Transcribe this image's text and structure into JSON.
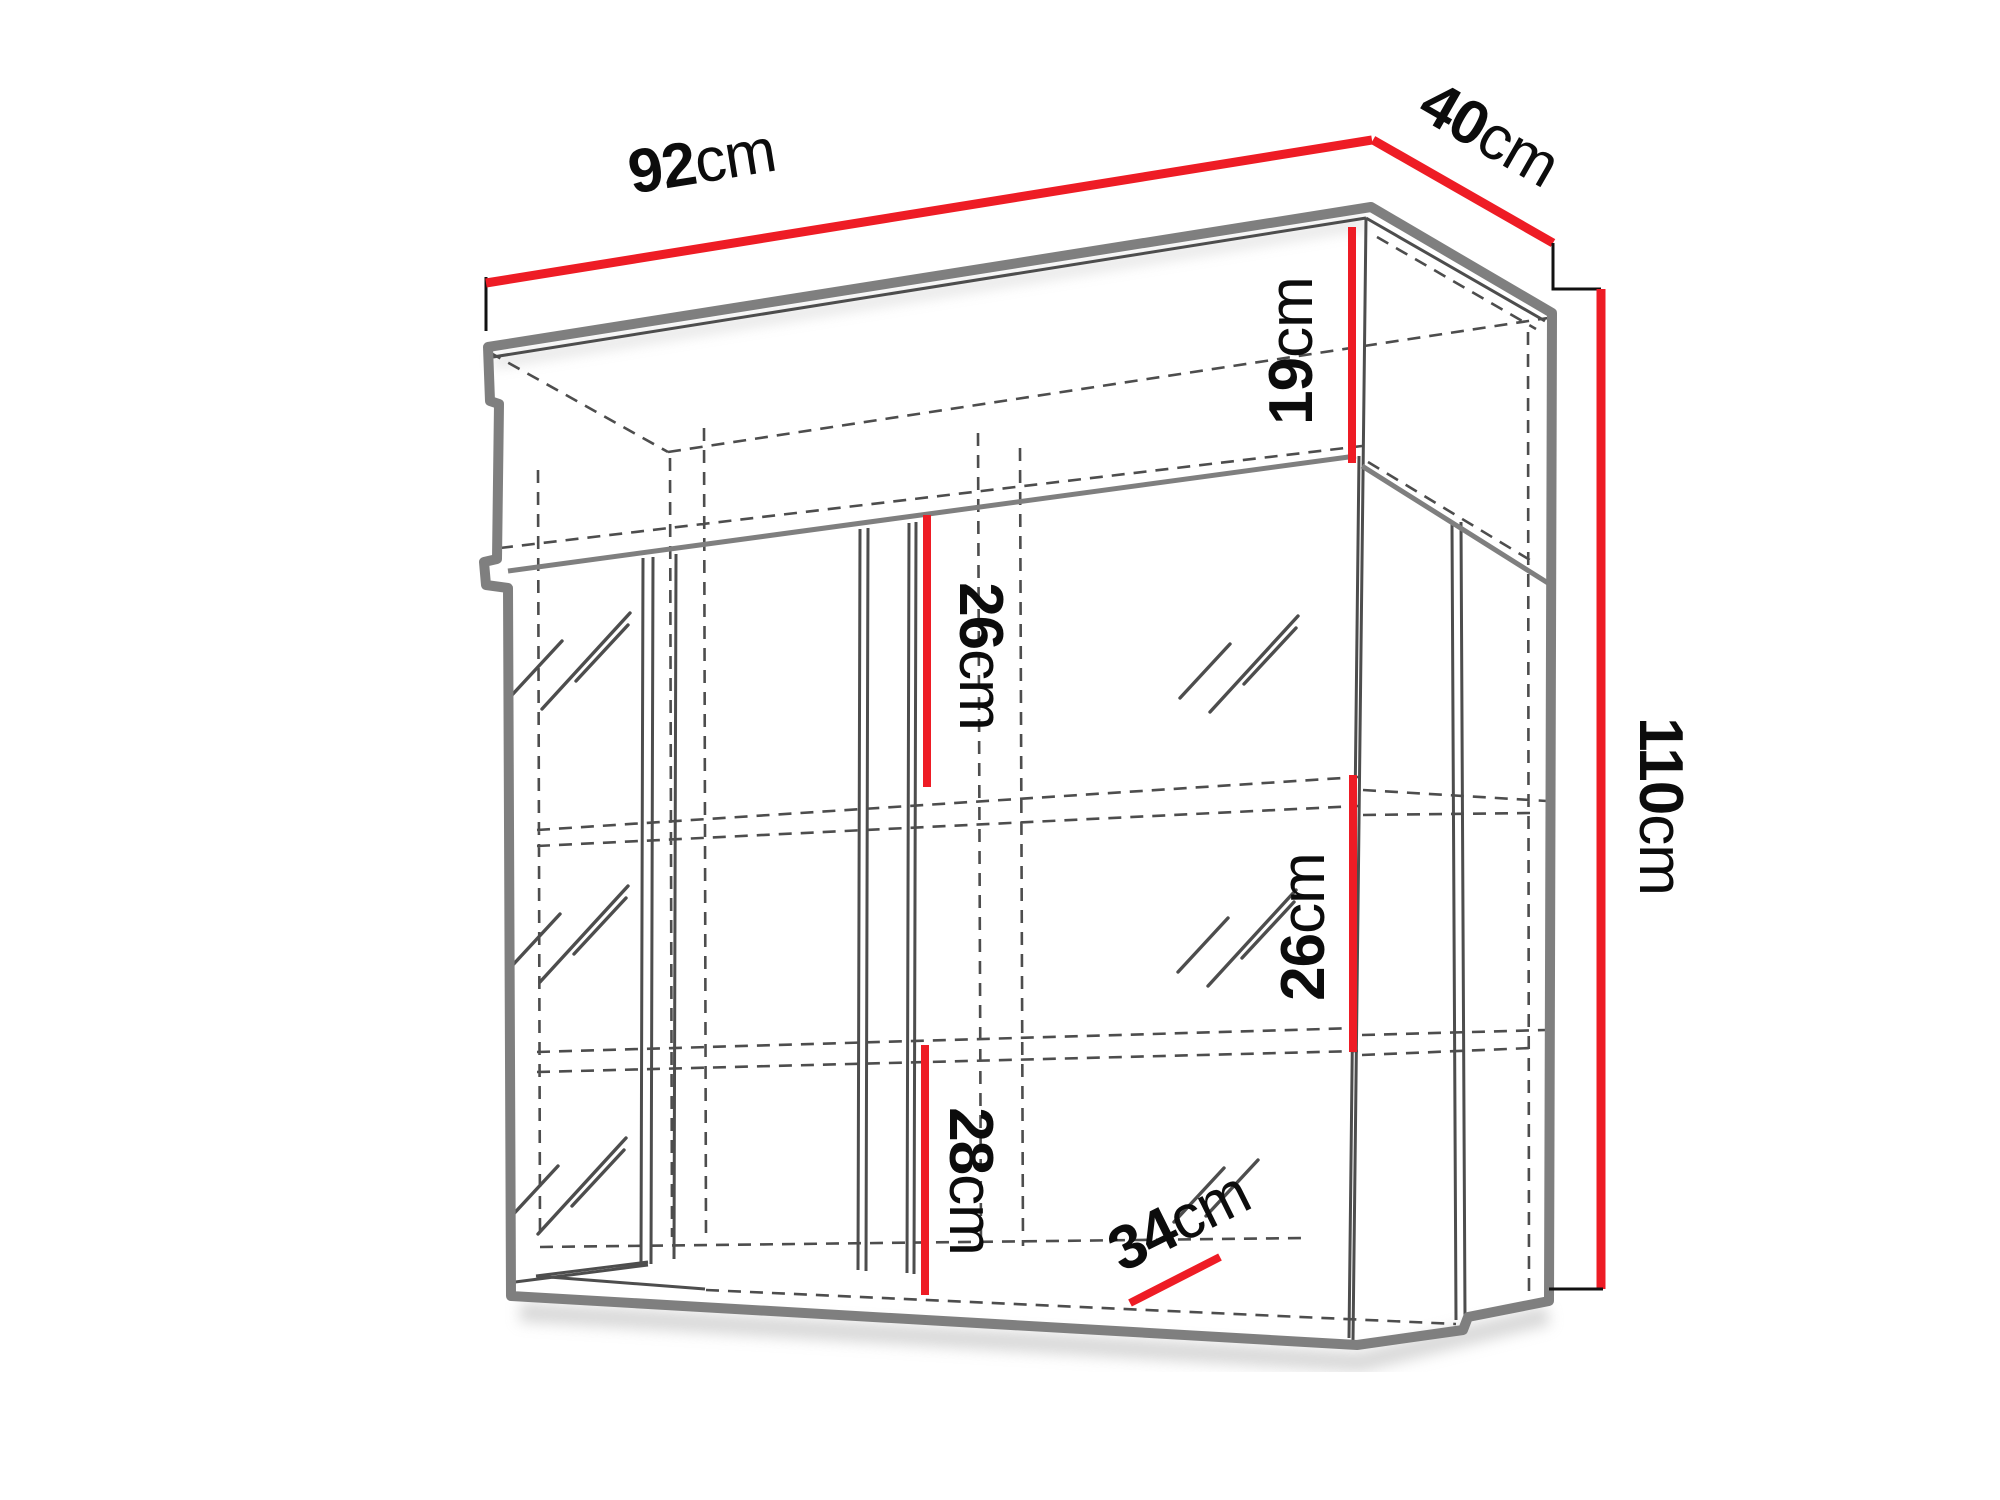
{
  "diagram": {
    "type": "furniture-dimension-drawing",
    "subject": "wall-mounted-display-cabinet"
  },
  "colors": {
    "dimension_line": "#ee1c25",
    "outline": "#7f7f7f",
    "detail": "#4d4d4d",
    "label_text": "#0c0c0c",
    "background": "#ffffff"
  },
  "dimensions": {
    "width": {
      "value": "92",
      "unit": "cm"
    },
    "depth": {
      "value": "40",
      "unit": "cm"
    },
    "height": {
      "value": "110",
      "unit": "cm"
    },
    "top_shelf": {
      "value": "19",
      "unit": "cm"
    },
    "middle_shelf": {
      "value": "26",
      "unit": "cm"
    },
    "right_shelf": {
      "value": "26",
      "unit": "cm"
    },
    "bottom_shelf": {
      "value": "28",
      "unit": "cm"
    },
    "interior_depth": {
      "value": "34",
      "unit": "cm"
    }
  }
}
